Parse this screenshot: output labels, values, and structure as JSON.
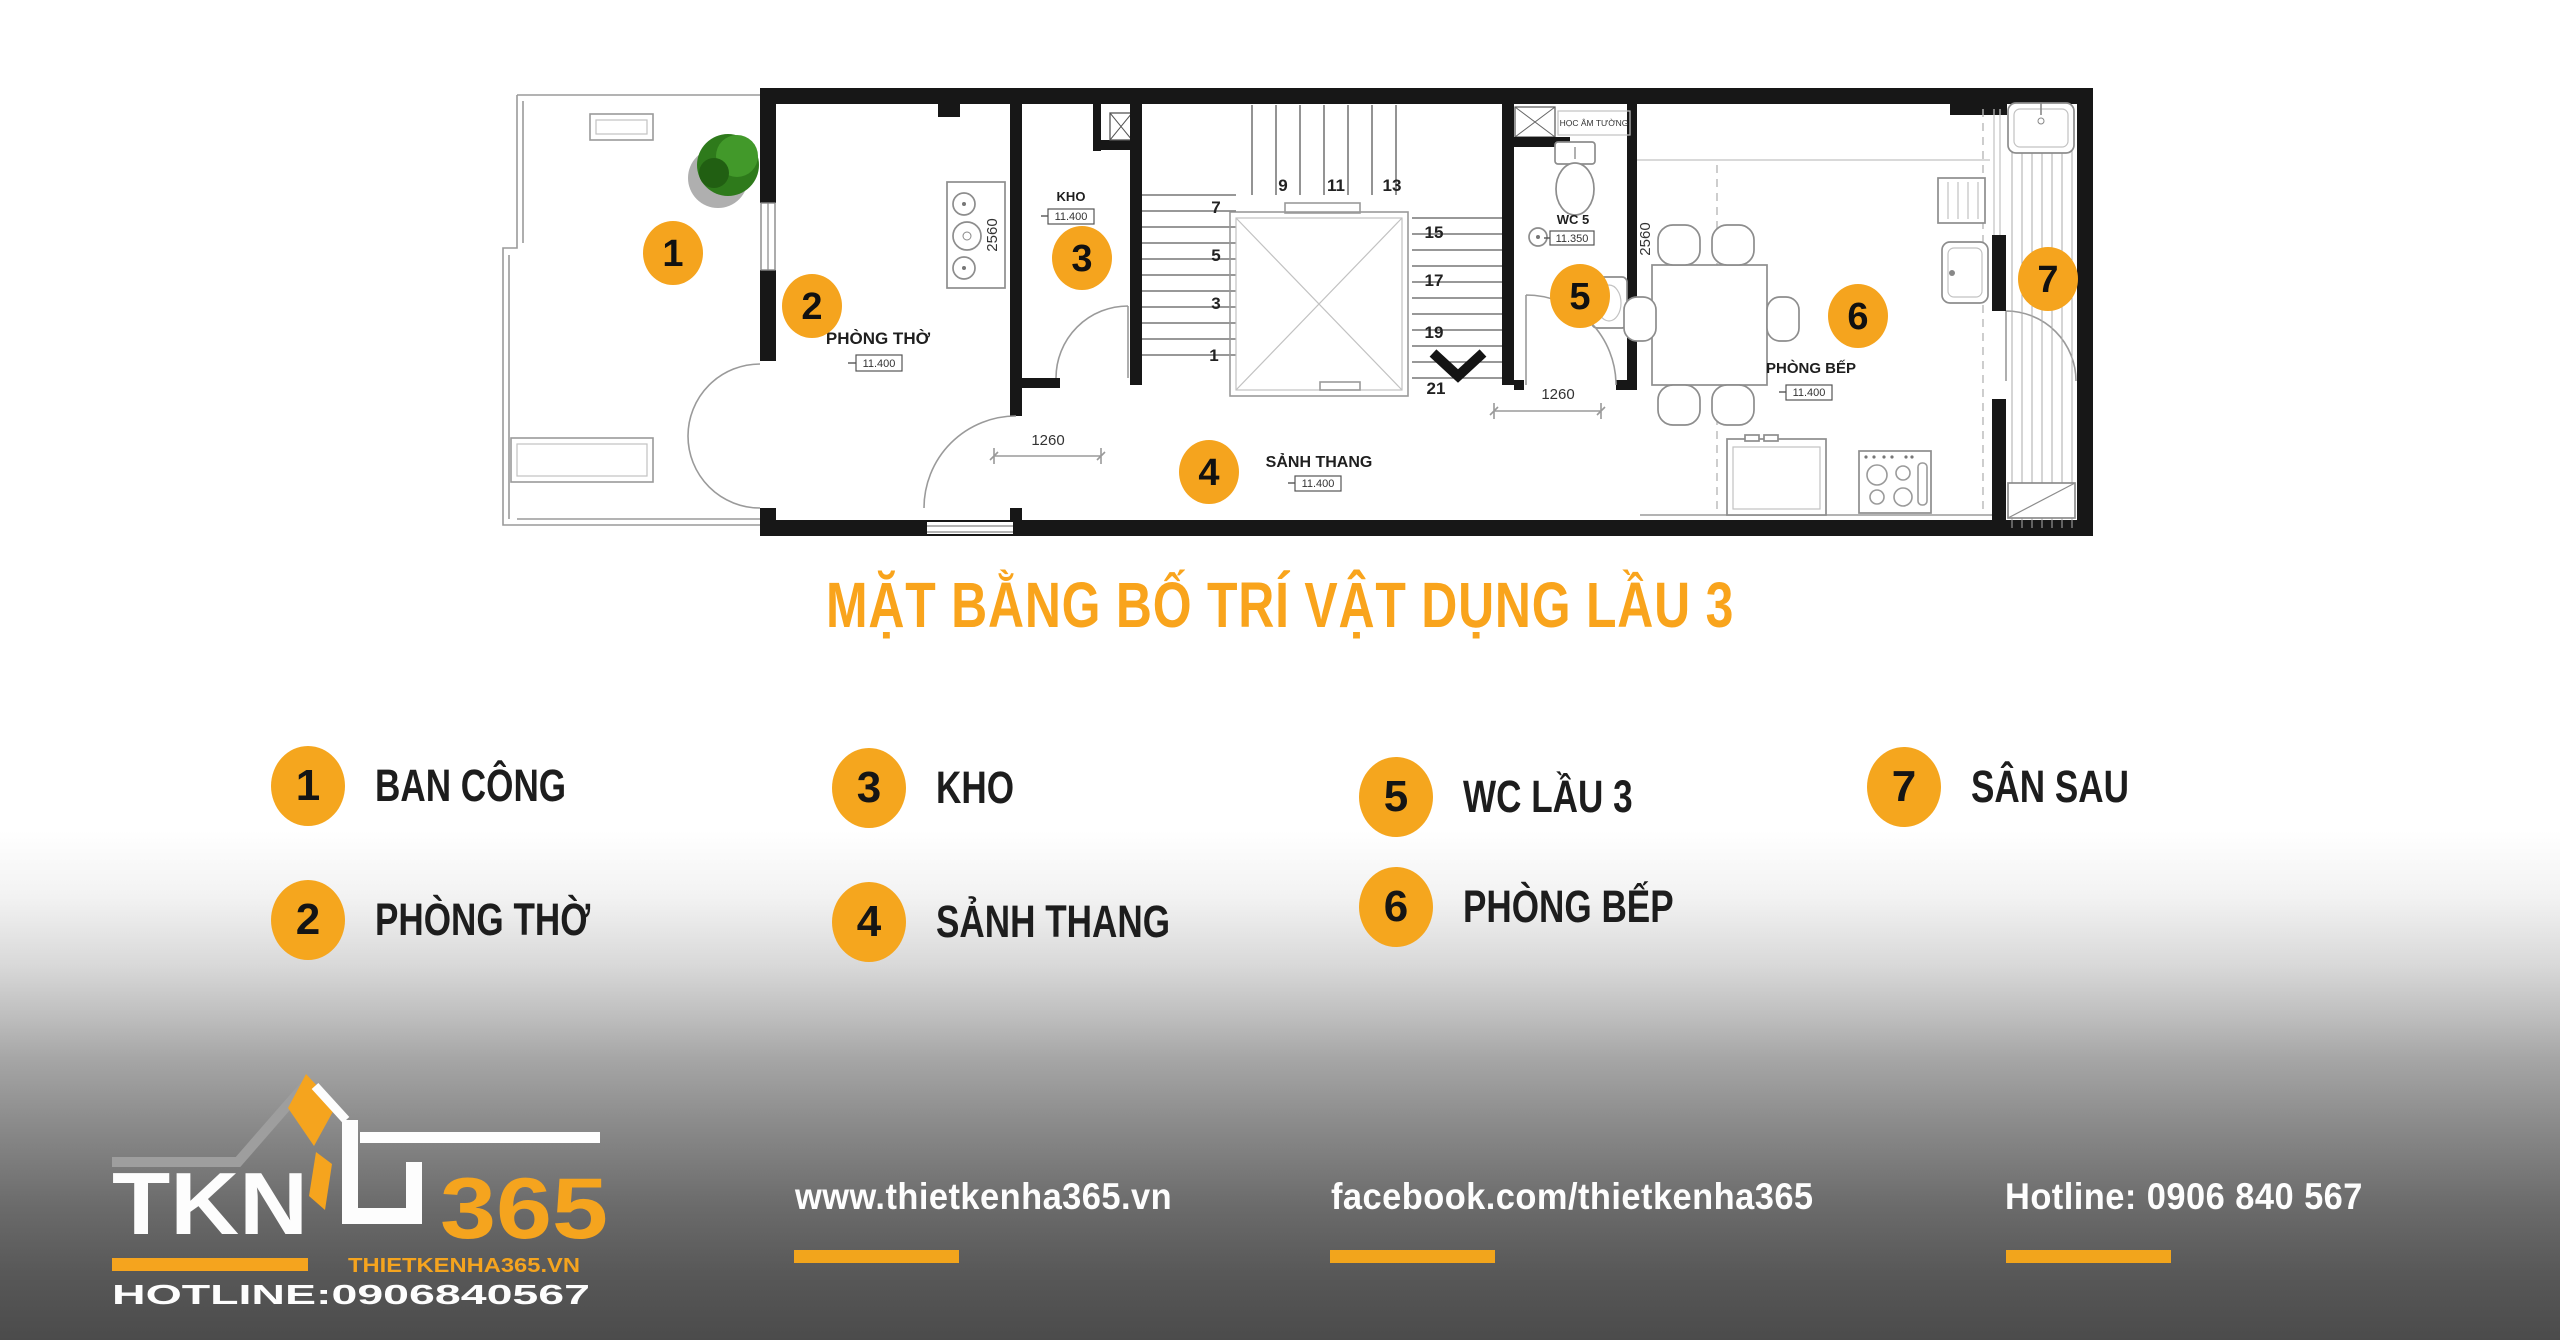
{
  "accent": "#F5A41E",
  "title": "MẶT BẰNG BỐ TRÍ VẬT DỤNG LẦU 3",
  "legend": {
    "items": [
      {
        "num": "1",
        "label": "BAN CÔNG"
      },
      {
        "num": "2",
        "label": "PHÒNG THỜ"
      },
      {
        "num": "3",
        "label": "KHO"
      },
      {
        "num": "4",
        "label": "SẢNH THANG"
      },
      {
        "num": "5",
        "label": "WC LẦU 3"
      },
      {
        "num": "6",
        "label": "PHÒNG BẾP"
      },
      {
        "num": "7",
        "label": "SÂN SAU"
      }
    ]
  },
  "plan": {
    "markers": [
      "1",
      "2",
      "3",
      "4",
      "5",
      "6",
      "7"
    ],
    "stairs": [
      "7",
      "5",
      "3",
      "1",
      "9",
      "11",
      "13",
      "15",
      "17",
      "19",
      "21"
    ],
    "rooms": {
      "tho": {
        "name": "PHÒNG THỜ",
        "level": "11.400"
      },
      "kho": {
        "name": "KHO",
        "level": "11.400"
      },
      "sanh": {
        "name": "SẢNH THANG",
        "level": "11.400"
      },
      "wc": {
        "name": "WC 5",
        "level": "11.350"
      },
      "bep": {
        "name": "PHÒNG BẾP",
        "level": "11.400"
      },
      "niche_label": "HỌC ÂM TƯỜNG"
    },
    "dims": {
      "altar": "2560",
      "kitchen": "2560",
      "door_left": "1260",
      "door_right": "1260"
    }
  },
  "footer": {
    "logo": {
      "tkn": "TKN",
      "n365": "365",
      "site": "THIETKENHA365.VN",
      "hotline": "HOTLINE:0906840567"
    },
    "links": [
      {
        "text": "www.thietkenha365.vn"
      },
      {
        "text": "facebook.com/thietkenha365"
      },
      {
        "text": "Hotline: 0906 840 567"
      }
    ]
  }
}
